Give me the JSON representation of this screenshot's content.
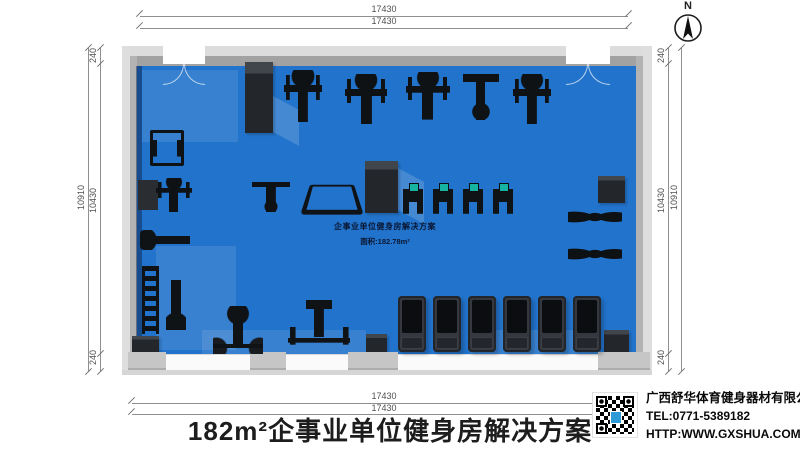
{
  "title": {
    "text": "182m²企事业单位健身房解决方案"
  },
  "north": {
    "label": "N"
  },
  "dimensions": {
    "top": [
      "17430",
      "17430"
    ],
    "bottom": [
      "17430",
      "17430"
    ],
    "left": {
      "outer": "10910",
      "segments": [
        "240",
        "10430",
        "240"
      ]
    },
    "right": {
      "outer": "10910",
      "segments": [
        "240",
        "10430",
        "240"
      ]
    }
  },
  "floor_label": {
    "line1": "企事业单位健身房解决方案",
    "line2": "面积:182.78m²"
  },
  "company": {
    "name": "广西舒华体育健身器材有限公司",
    "tel": "TEL:0771-5389182",
    "web": "HTTP:WWW.GXSHUA.COM"
  },
  "colors": {
    "floor_blue": "#2273cb",
    "wall_light": "#dcdcdc",
    "wall_dark": "#a2a2a2",
    "pillar": "#23262b",
    "equipment": "#0f1215",
    "stepper_screen": "#17b3a2",
    "qr_logo_blue": "#2e9bd6"
  },
  "plan": {
    "items": [
      {
        "type": "navy",
        "name": "wall-shadow-left",
        "x": 136,
        "y": 66,
        "w": 6,
        "h": 288
      },
      {
        "type": "patch",
        "name": "floor-highlight",
        "x": 142,
        "y": 70,
        "w": 96,
        "h": 72
      },
      {
        "type": "patch",
        "name": "floor-highlight",
        "x": 156,
        "y": 246,
        "w": 80,
        "h": 104
      },
      {
        "type": "patch",
        "name": "floor-highlight",
        "x": 202,
        "y": 330,
        "w": 164,
        "h": 24
      },
      {
        "type": "patch",
        "name": "floor-highlight",
        "x": 470,
        "y": 330,
        "w": 128,
        "h": 24
      },
      {
        "type": "shade",
        "name": "pillar-shadow",
        "x": 273,
        "y": 96,
        "w": 26,
        "h": 36
      },
      {
        "type": "shade",
        "name": "pillar-shadow",
        "x": 398,
        "y": 168,
        "w": 26,
        "h": 42
      },
      {
        "type": "pillar",
        "name": "column",
        "x": 245,
        "y": 62,
        "w": 28,
        "h": 71
      },
      {
        "type": "pillar",
        "name": "column",
        "x": 365,
        "y": 161,
        "w": 33,
        "h": 52
      },
      {
        "type": "pillar",
        "name": "column",
        "x": 598,
        "y": 176,
        "w": 27,
        "h": 27
      },
      {
        "type": "pillar",
        "name": "column",
        "x": 132,
        "y": 336,
        "w": 27,
        "h": 22
      },
      {
        "type": "pillar",
        "name": "column",
        "x": 366,
        "y": 334,
        "w": 21,
        "h": 24
      },
      {
        "type": "pillar",
        "name": "column",
        "x": 604,
        "y": 330,
        "w": 25,
        "h": 28
      },
      {
        "type": "door",
        "name": "door-top-left",
        "x": 163,
        "y": 46,
        "w": 42,
        "h": 18
      },
      {
        "type": "door",
        "name": "door-top-right",
        "x": 566,
        "y": 46,
        "w": 44,
        "h": 18
      },
      {
        "type": "stub",
        "name": "window-pier",
        "x": 128,
        "y": 352,
        "w": 38,
        "h": 16
      },
      {
        "type": "stub",
        "name": "window-pier",
        "x": 250,
        "y": 352,
        "w": 36,
        "h": 16
      },
      {
        "type": "stub",
        "name": "window-pier",
        "x": 348,
        "y": 352,
        "w": 50,
        "h": 16
      },
      {
        "type": "stub",
        "name": "window-pier",
        "x": 598,
        "y": 352,
        "w": 52,
        "h": 16
      },
      {
        "type": "strength",
        "name": "strength-machine",
        "x": 284,
        "y": 70,
        "w": 38,
        "h": 52
      },
      {
        "type": "strength",
        "name": "strength-machine",
        "x": 345,
        "y": 74,
        "w": 42,
        "h": 50
      },
      {
        "type": "strength",
        "name": "strength-machine",
        "x": 406,
        "y": 72,
        "w": 44,
        "h": 48
      },
      {
        "type": "tbench",
        "name": "adjustable-bench",
        "x": 463,
        "y": 74,
        "w": 36,
        "h": 46
      },
      {
        "type": "strength",
        "name": "strength-machine",
        "x": 513,
        "y": 74,
        "w": 38,
        "h": 50
      },
      {
        "type": "frame",
        "name": "squat-rack",
        "x": 150,
        "y": 130,
        "w": 34,
        "h": 36
      },
      {
        "type": "box",
        "name": "equipment-box",
        "x": 138,
        "y": 180,
        "w": 20,
        "h": 30
      },
      {
        "type": "strength",
        "name": "strength-machine",
        "x": 156,
        "y": 178,
        "w": 36,
        "h": 34
      },
      {
        "type": "bench-h",
        "name": "flat-bench",
        "x": 140,
        "y": 230,
        "w": 50,
        "h": 20
      },
      {
        "type": "rack",
        "name": "dumbbell-rack",
        "x": 142,
        "y": 266,
        "w": 17,
        "h": 68
      },
      {
        "type": "bench-v",
        "name": "incline-bench",
        "x": 166,
        "y": 280,
        "w": 20,
        "h": 50
      },
      {
        "type": "tbench",
        "name": "ab-bench",
        "x": 252,
        "y": 182,
        "w": 38,
        "h": 30
      },
      {
        "type": "dipframe",
        "name": "dip-station",
        "x": 306,
        "y": 180,
        "w": 52,
        "h": 34
      },
      {
        "type": "stepper",
        "name": "stepper",
        "x": 403,
        "y": 183,
        "w": 20,
        "h": 31
      },
      {
        "type": "stepper",
        "name": "stepper",
        "x": 433,
        "y": 183,
        "w": 20,
        "h": 31
      },
      {
        "type": "stepper",
        "name": "stepper",
        "x": 463,
        "y": 183,
        "w": 20,
        "h": 31
      },
      {
        "type": "stepper",
        "name": "stepper",
        "x": 493,
        "y": 183,
        "w": 20,
        "h": 31
      },
      {
        "type": "bike",
        "name": "spin-bike",
        "x": 568,
        "y": 203,
        "w": 54,
        "h": 28
      },
      {
        "type": "bike",
        "name": "spin-bike",
        "x": 568,
        "y": 240,
        "w": 54,
        "h": 28
      },
      {
        "type": "benchpress",
        "name": "bench-press",
        "x": 213,
        "y": 306,
        "w": 50,
        "h": 48
      },
      {
        "type": "bbrack",
        "name": "barbell-rack",
        "x": 288,
        "y": 300,
        "w": 62,
        "h": 52
      },
      {
        "type": "treadmill",
        "name": "treadmill",
        "x": 398,
        "y": 296,
        "w": 28,
        "h": 56
      },
      {
        "type": "treadmill",
        "name": "treadmill",
        "x": 433,
        "y": 296,
        "w": 28,
        "h": 56
      },
      {
        "type": "treadmill",
        "name": "treadmill",
        "x": 468,
        "y": 296,
        "w": 28,
        "h": 56
      },
      {
        "type": "treadmill",
        "name": "treadmill",
        "x": 503,
        "y": 296,
        "w": 28,
        "h": 56
      },
      {
        "type": "treadmill",
        "name": "treadmill",
        "x": 538,
        "y": 296,
        "w": 28,
        "h": 56
      },
      {
        "type": "treadmill",
        "name": "treadmill",
        "x": 573,
        "y": 296,
        "w": 28,
        "h": 56
      }
    ]
  }
}
